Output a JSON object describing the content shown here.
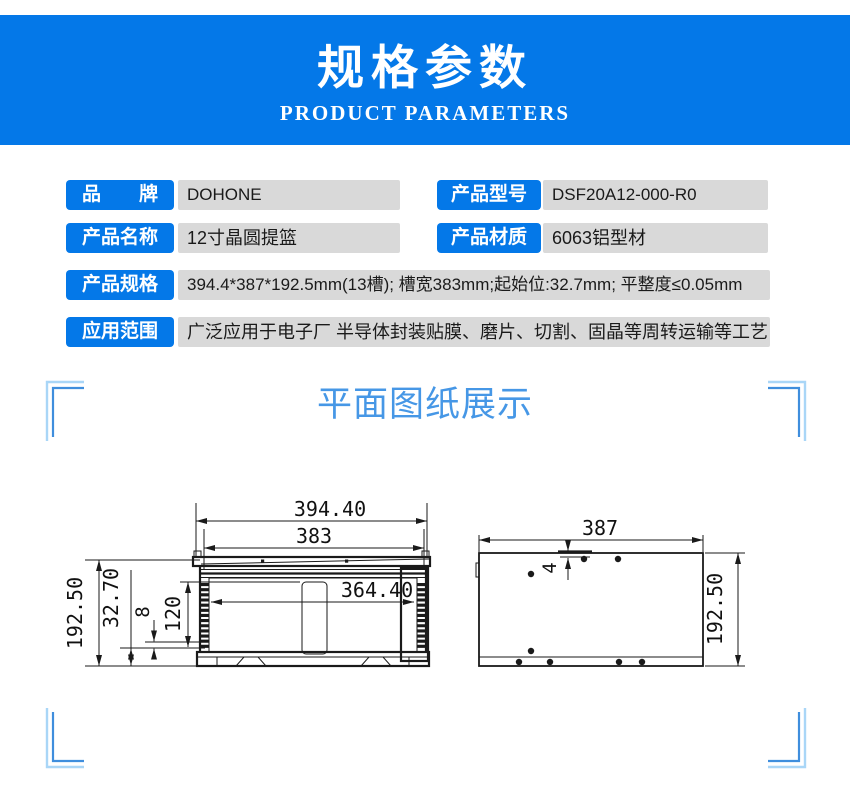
{
  "banner": {
    "title": "规格参数",
    "subtitle": "PRODUCT PARAMETERS",
    "bg_color": "#0478e8",
    "text_color": "#ffffff"
  },
  "specs": {
    "label_bg": "#0478e8",
    "value_bg": "#d9d9d9",
    "rows": [
      {
        "label": "品　　牌",
        "value": "DOHONE"
      },
      {
        "label": "产品型号",
        "value": "DSF20A12-000-R0"
      },
      {
        "label": "产品名称",
        "value": "12寸晶圆提篮"
      },
      {
        "label": "产品材质",
        "value": "6063铝型材"
      },
      {
        "label": "产品规格",
        "value": "394.4*387*192.5mm(13槽); 槽宽383mm;起始位:32.7mm; 平整度≤0.05mm"
      },
      {
        "label": "应用范围",
        "value": "广泛应用于电子厂 半导体封装贴膜、磨片、切割、固晶等周转运输等工艺"
      }
    ]
  },
  "section": {
    "title": "平面图纸展示",
    "title_color": "#4697e6",
    "bracket_dark": "#3f8edd",
    "bracket_light": "#a9d6f7"
  },
  "drawings": {
    "front": {
      "overall_width": "394.40",
      "top_width": "383",
      "inner_width": "364.40",
      "overall_height": "192.50",
      "start_position": "32.70",
      "slot_pitch": "8",
      "slot_depth": "120",
      "slot_count_note": "13槽"
    },
    "side": {
      "width": "387",
      "top_offset": "4",
      "height": "192.50"
    }
  }
}
